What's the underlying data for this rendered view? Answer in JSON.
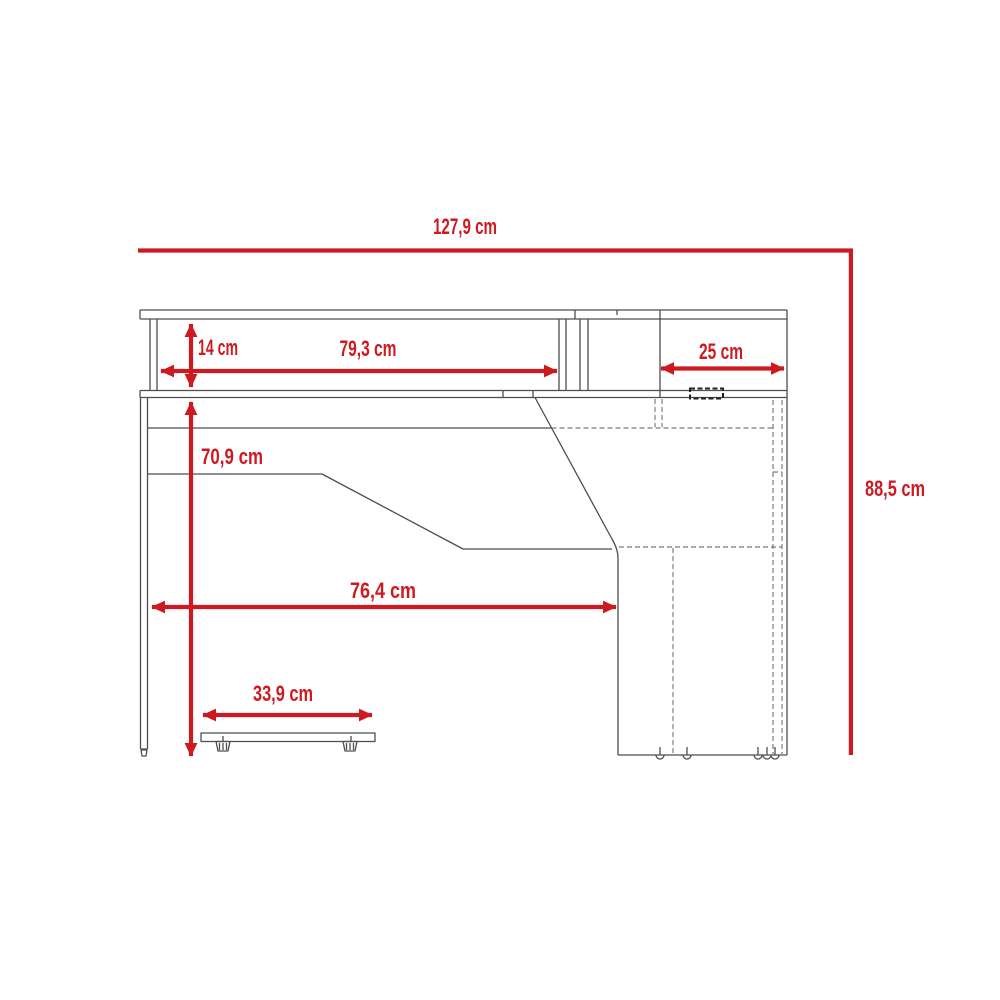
{
  "page": {
    "background_color": "#ffffff"
  },
  "drawing": {
    "kind": "furniture dimension diagram",
    "accent_color": "#cd1a20",
    "line_color": "#4e4e50",
    "dimensions": {
      "total_width": "127,9 cm",
      "total_height": "88,5 cm",
      "hutch_height": "14 cm",
      "hutch_shelf_width": "79,3 cm",
      "right_shelf_width": "25 cm",
      "desk_surface_height": "70,9 cm",
      "desk_surface_width": "76,4 cm",
      "footrest_width": "33,9 cm"
    }
  }
}
